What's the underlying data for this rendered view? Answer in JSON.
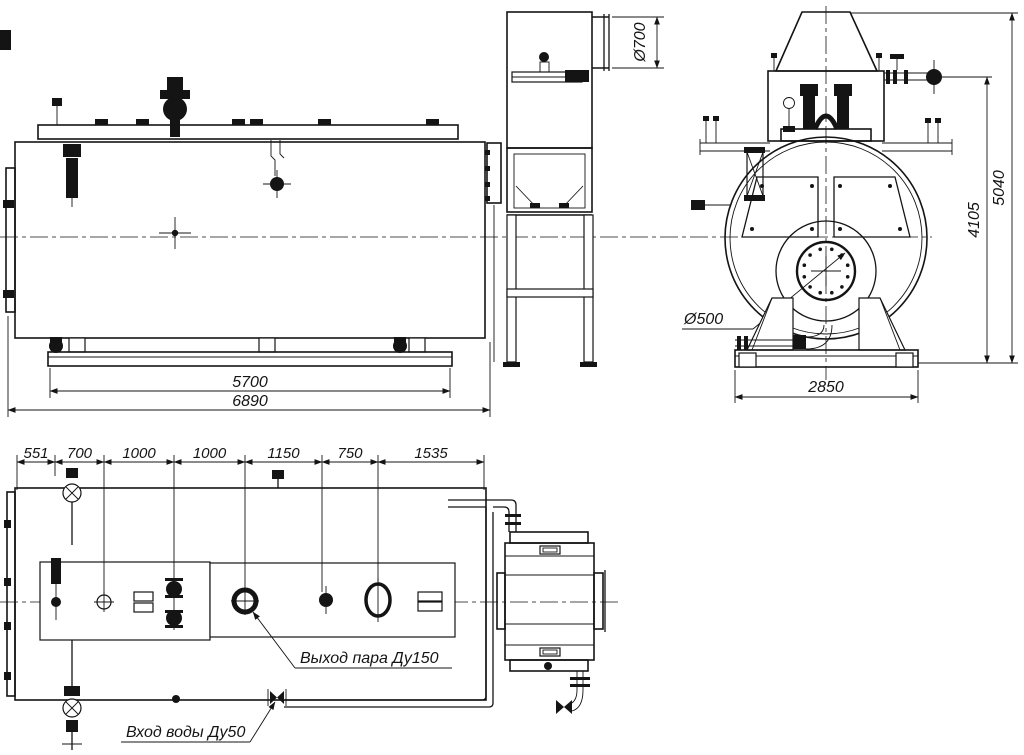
{
  "drawing": {
    "line_color": "#141414",
    "background_color": "#ffffff",
    "views": {
      "side_elevation": {
        "dim_skid_length": "5700",
        "dim_overall_length": "6890"
      },
      "flue_stack": {
        "dim_duct_diameter": "Ø700"
      },
      "front_elevation": {
        "dim_height_to_valve": "4105",
        "dim_overall_height": "5040",
        "dim_base_width": "2850",
        "label_burner_opening": "Ø500"
      },
      "plan": {
        "dim_chain": [
          "551",
          "700",
          "1000",
          "1000",
          "1150",
          "750",
          "1535"
        ],
        "label_steam_outlet": "Выход пара Ду150",
        "label_water_inlet": "Вход воды Ду50"
      }
    }
  }
}
